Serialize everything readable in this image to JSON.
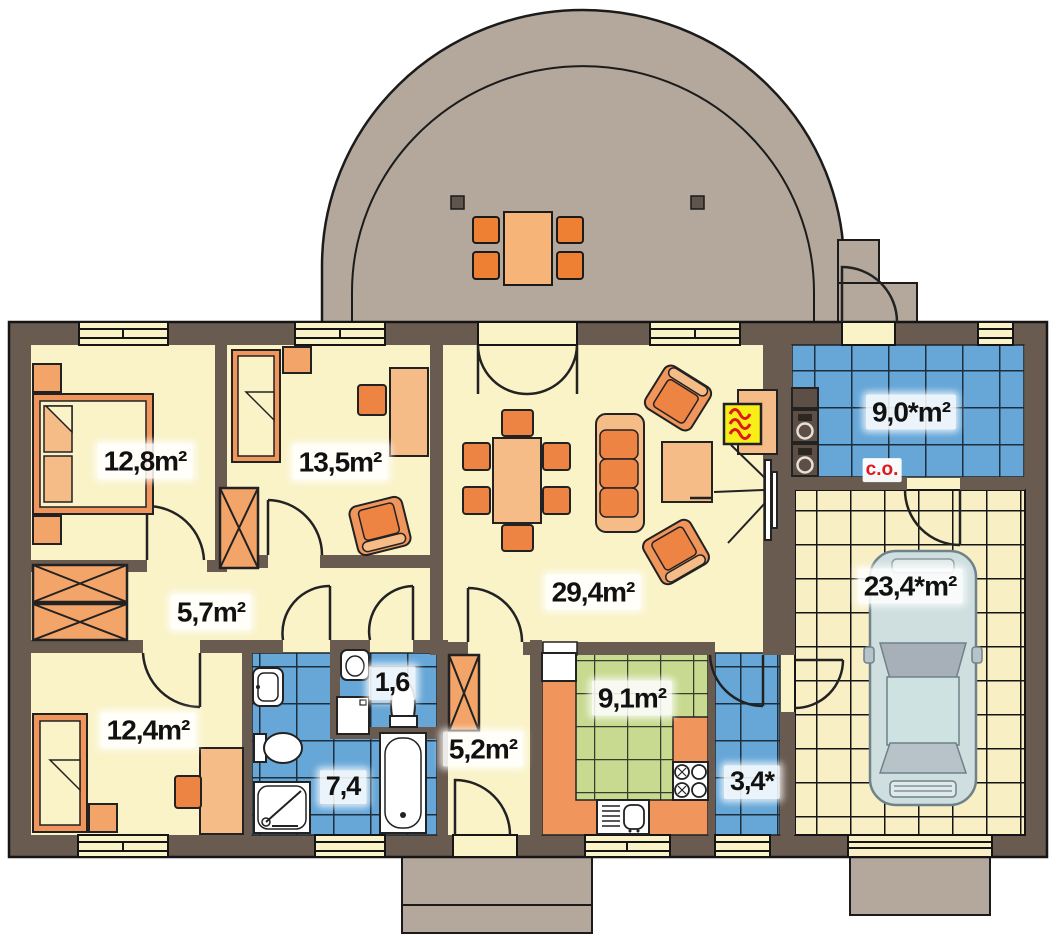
{
  "floorplan": {
    "type": "single-storey house plan with garage and semicircular terrace",
    "rooms": [
      {
        "name": "bedroom-main",
        "area_label": "12,8m²"
      },
      {
        "name": "bedroom-2",
        "area_label": "13,5m²"
      },
      {
        "name": "hall",
        "area_label": "5,7m²"
      },
      {
        "name": "bedroom-3",
        "area_label": "12,4m²"
      },
      {
        "name": "wc",
        "area_label": "1,6"
      },
      {
        "name": "bathroom",
        "area_label": "7,4"
      },
      {
        "name": "corridor",
        "area_label": "5,2m²"
      },
      {
        "name": "living-room",
        "area_label": "29,4m²"
      },
      {
        "name": "kitchen",
        "area_label": "9,1m²"
      },
      {
        "name": "utility-room",
        "area_label": "3,4*"
      },
      {
        "name": "boiler-room",
        "area_label": "9,0*m²"
      },
      {
        "name": "garage",
        "area_label": "23,4*m²"
      }
    ],
    "annotations": {
      "central_heating": "c.o."
    },
    "colors": {
      "wall": "#6a5b50",
      "floor_cream": "#faf3c8",
      "terrace_gray": "#b3a89b",
      "tile_blue": "#66a7d8",
      "tile_green": "#c8da90",
      "tile_garage": "#f8efc5",
      "furniture_orange": "#f0965c",
      "furniture_light_orange": "#f6bc88",
      "furniture_dark_orange": "#ee8443",
      "fireplace_yellow": "#f8ee18",
      "heating_red": "#e01818",
      "car_body": "#cfdfe0"
    }
  }
}
